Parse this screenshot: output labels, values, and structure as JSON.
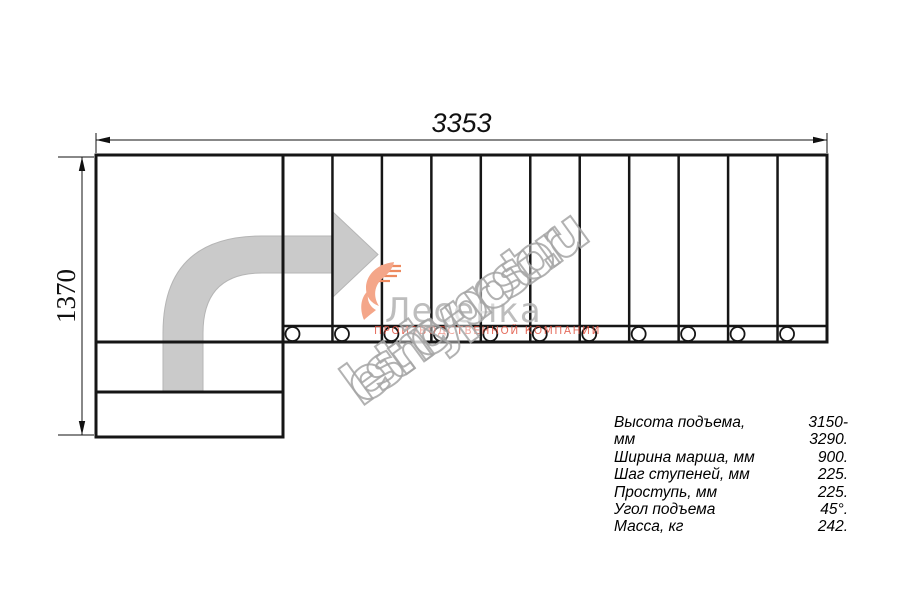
{
  "dimensions": {
    "width_label": "3353",
    "height_label": "1370"
  },
  "plan": {
    "treads": 11,
    "landing_steps": 2,
    "direction_arrow": "quarter-turn-up-right"
  },
  "watermark": {
    "site_text": "lestnicy-prosto.ru",
    "logo_text": "Лесенка",
    "logo_subtext": "производственной компании"
  },
  "specs": {
    "rows": [
      {
        "label": "Высота подъема, мм",
        "value": "3150-3290."
      },
      {
        "label": "Ширина марша, мм",
        "value": "900."
      },
      {
        "label": "Шаг ступеней, мм",
        "value": "225."
      },
      {
        "label": "Проступь, мм",
        "value": "225."
      },
      {
        "label": "Угол подъема",
        "value": "45°."
      },
      {
        "label": "Масса, кг",
        "value": "242."
      }
    ]
  },
  "colors": {
    "line": "#161616",
    "arrow_fill": "#cacaca",
    "arrow_edge": "#b5b5b5",
    "watermark_gray": "#a5a5a5",
    "logo_orange": "#f4a689",
    "logo_stripe": "#ed8a5f",
    "logo_red": "#de4a37"
  }
}
